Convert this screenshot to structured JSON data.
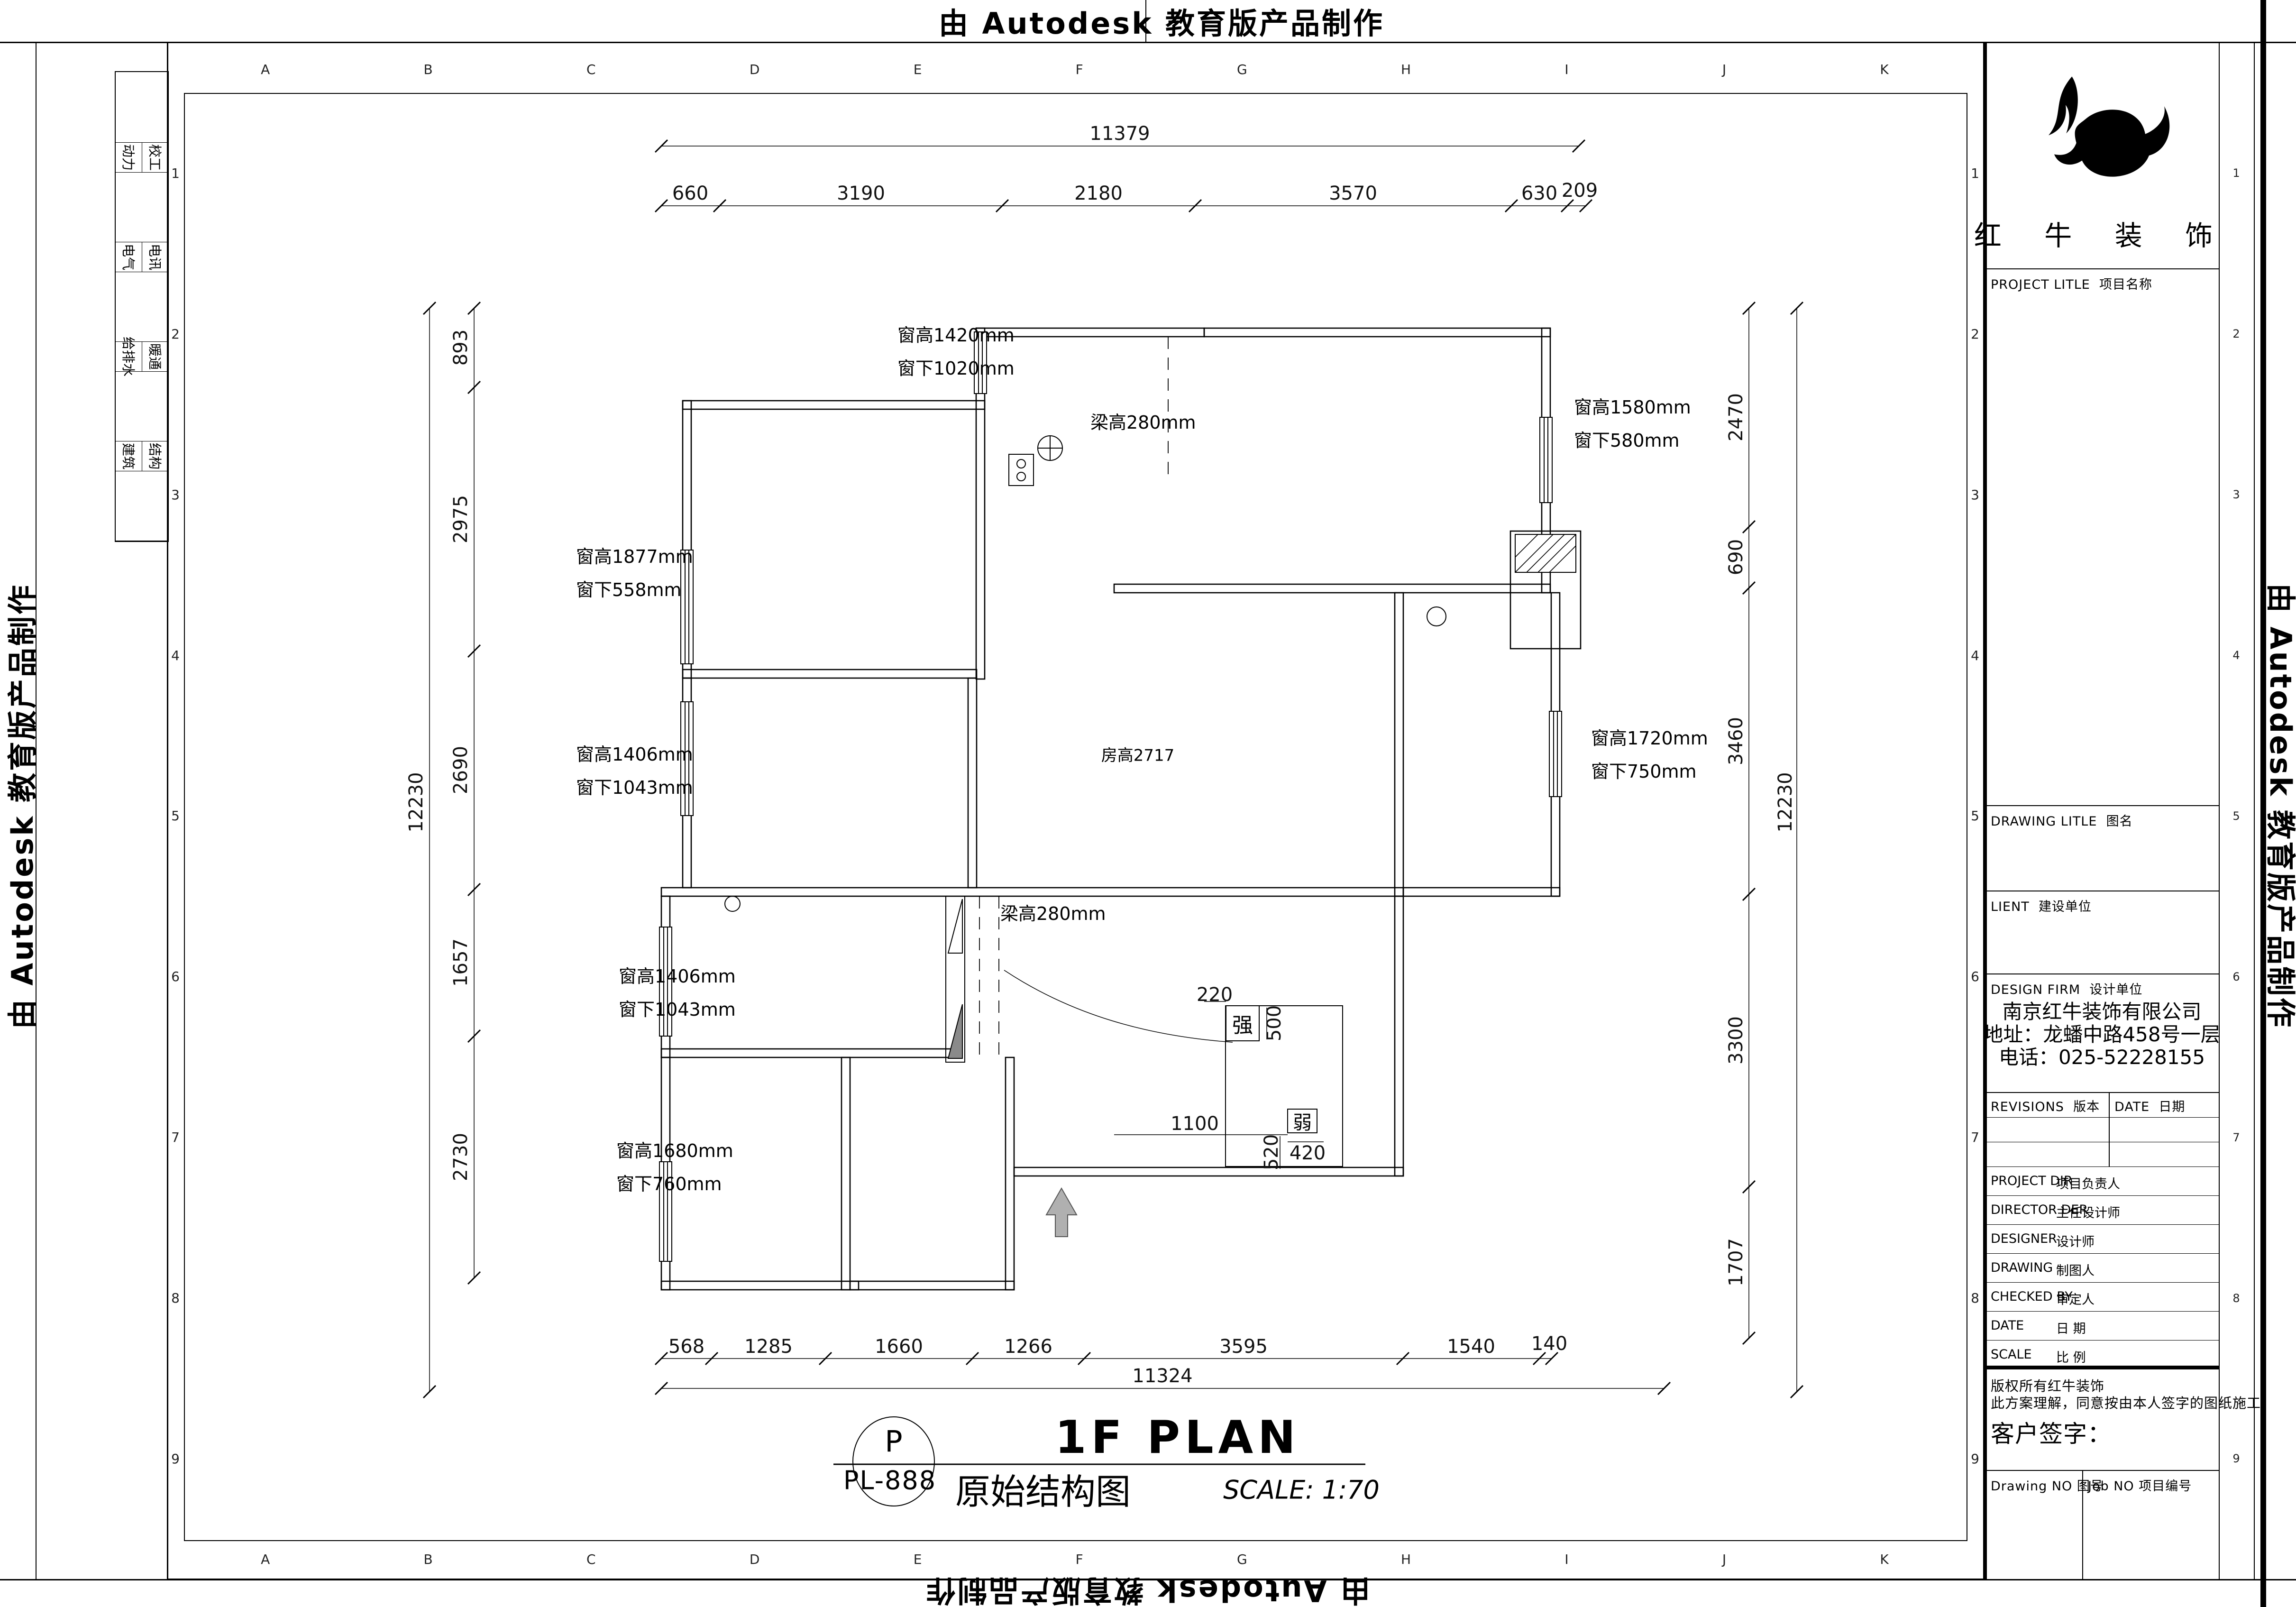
{
  "stamp": {
    "text": "由 Autodesk 教育版产品制作"
  },
  "sheet": {
    "grid_letters": [
      "A",
      "B",
      "C",
      "D",
      "E",
      "F",
      "G",
      "H",
      "I",
      "J",
      "K"
    ],
    "grid_numbers": [
      "1",
      "2",
      "3",
      "4",
      "5",
      "6",
      "7",
      "8",
      "9"
    ],
    "signature_rows": [
      [
        "动力",
        "校工"
      ],
      [
        "电气",
        "电讯"
      ],
      [
        "给排水",
        "暖通"
      ],
      [
        "建筑",
        "结构"
      ]
    ]
  },
  "title_block": {
    "brand": "红 牛 装 饰",
    "project_title_en": "PROJECT LITLE",
    "project_title_cn": "项目名称",
    "drawing_title_en": "DRAWING LITLE",
    "drawing_title_cn": "图名",
    "client_en": "LIENT",
    "client_cn": "建设单位",
    "design_firm_en": "DESIGN FIRM",
    "design_firm_cn": "设计单位",
    "company_name": "南京红牛装饰有限公司",
    "company_address": "地址：龙蟠中路458号一层",
    "company_phone": "电话：025-52228155",
    "revisions_en": "REVISIONS",
    "revisions_cn": "版本",
    "date_en": "DATE",
    "date_cn": "日期",
    "staff_rows": [
      [
        "PROJECT DIR",
        "项目负责人"
      ],
      [
        "DIRECTOR DER",
        "主任设计师"
      ],
      [
        "DESIGNER",
        "设计师"
      ],
      [
        "DRAWING",
        "制图人"
      ],
      [
        "CHECKED BY",
        "审定人"
      ],
      [
        "DATE",
        "日 期"
      ],
      [
        "SCALE",
        "比 例"
      ]
    ],
    "copyright_line1": "版权所有红牛装饰",
    "copyright_line2": "此方案理解，同意按由本人签字的图纸施工；",
    "client_sign": "客户签字：",
    "drawing_no_en": "Drawing NO",
    "drawing_no_cn": "图号",
    "job_no_en": "Job NO",
    "job_no_cn": "项目编号"
  },
  "plan": {
    "room_height": "房高2717",
    "beam_labels": [
      "梁高280mm",
      "梁高280mm"
    ],
    "windows": {
      "w1420": [
        "窗高1420mm",
        "窗下1020mm"
      ],
      "w1580": [
        "窗高1580mm",
        "窗下580mm"
      ],
      "w1877": [
        "窗高1877mm",
        "窗下558mm"
      ],
      "w1406a": [
        "窗高1406mm",
        "窗下1043mm"
      ],
      "w1720": [
        "窗高1720mm",
        "窗下750mm"
      ],
      "w1406b": [
        "窗高1406mm",
        "窗下1043mm"
      ],
      "w1680": [
        "窗高1680mm",
        "窗下760mm"
      ]
    },
    "electrical": {
      "strong": "强",
      "weak": "弱",
      "d220": "220",
      "d500": "500",
      "d1100": "1100",
      "d520": "520",
      "d420": "420"
    },
    "dims": {
      "top_overall": "11379",
      "top": [
        "660",
        "3190",
        "2180",
        "3570",
        "630",
        "209"
      ],
      "bottom_overall": "11324",
      "bottom": [
        "568",
        "1285",
        "1660",
        "1266",
        "3595",
        "1540",
        "140"
      ],
      "left_overall": "12230",
      "left": [
        "893",
        "2975",
        "2690",
        "1657",
        "2730"
      ],
      "right_overall": "12230",
      "right": [
        "2470",
        "690",
        "3460",
        "3300",
        "1707"
      ]
    }
  },
  "title_bar": {
    "tag": "P",
    "code": "PL-888",
    "title_en": "1F PLAN",
    "title_cn": "原始结构图",
    "scale_text": "SCALE: 1:70"
  }
}
